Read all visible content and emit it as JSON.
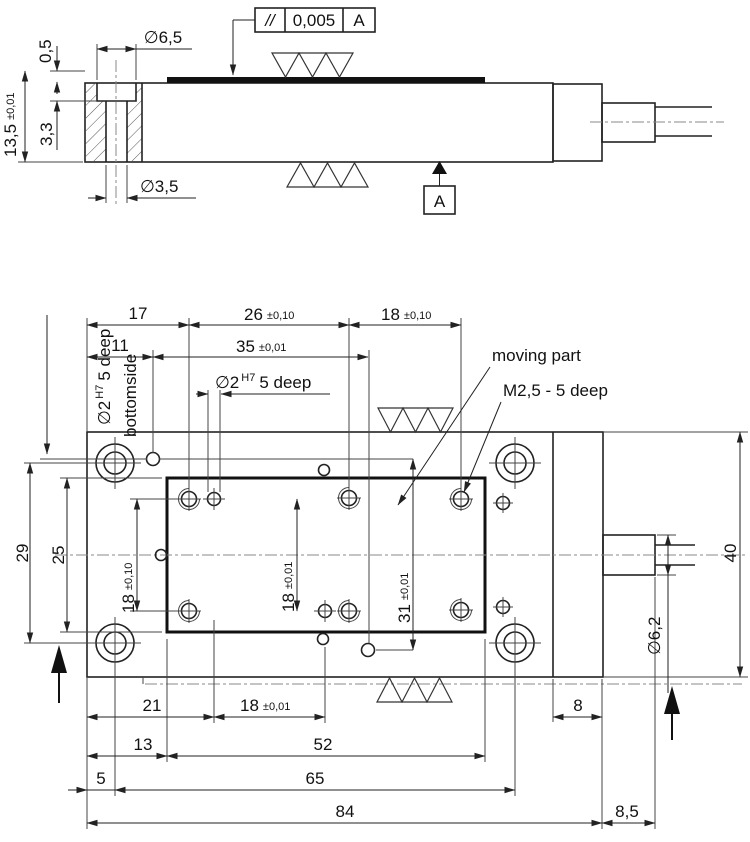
{
  "side_view": {
    "counterbore_dia": "∅6,5",
    "step_height": "0,5",
    "total_height": "13,5",
    "total_height_tol": "±0,01",
    "counterbore_depth": "3,3",
    "hole_dia": "∅3,5",
    "parallelism": {
      "symbol": "//",
      "value": "0,005",
      "datum": "A"
    },
    "datum_flag": "A"
  },
  "plan_view": {
    "top_dims": {
      "d17": "17",
      "d26": "26",
      "d26_tol": "±0,10",
      "d18": "18",
      "d18_tol": "±0,10",
      "d11": "11",
      "d35": "35",
      "d35_tol": "±0,01"
    },
    "labels": {
      "fit_hole_dia": "∅2",
      "fit_hole_fit": "H7",
      "fit_hole_depth": "5 deep",
      "moving_part": "moving part",
      "thread": "M2,5 - 5 deep",
      "bottom_hole_dia": "∅2",
      "bottom_hole_fit": "H7",
      "bottom_hole_depth": "5 deep",
      "bottom_hole_side": "bottomside"
    },
    "left_dims": {
      "d29": "29",
      "d25": "25",
      "d18": "18",
      "d18_tol": "±0,10"
    },
    "center_dims": {
      "d18": "18",
      "d18_tol": "±0,01",
      "d31": "31",
      "d31_tol": "±0,01"
    },
    "right_dims": {
      "d40": "40",
      "d6_2": "∅6,2"
    },
    "bottom_dims": {
      "d21": "21",
      "d18": "18",
      "d18_tol": "±0,01",
      "d8": "8",
      "d13": "13",
      "d52": "52",
      "d5": "5",
      "d65": "65",
      "d84": "84",
      "d8_5": "8,5"
    }
  }
}
